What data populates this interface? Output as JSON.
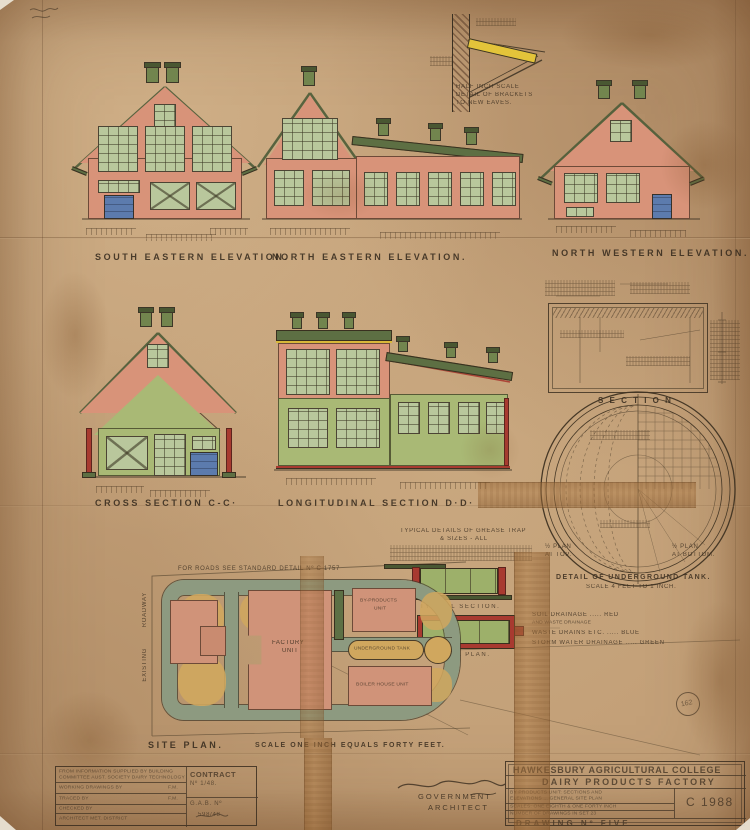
{
  "palette": {
    "paper": "#c3a078",
    "building_pink": "#d89379",
    "roof_green": "#5d6f43",
    "wall_green": "#a9b975",
    "window_green": "#b9c79c",
    "door_blue": "#5c7bad",
    "accent_red": "#a83a30",
    "beam_yellow": "#e3c43a",
    "road_grey": "#8d9a80",
    "sand": "#d0a75e",
    "ink": "#3a2d1f"
  },
  "captions": {
    "south_eastern": "SOUTH EASTERN ELEVATION.",
    "north_eastern": "NORTH EASTERN ELEVATION.",
    "north_western": "NORTH WESTERN ELEVATION.",
    "cross_section": "CROSS SECTION C-C·",
    "longitudinal_section": "LONGITUDINAL SECTION D·D·",
    "roof_section": "S E C T I O N"
  },
  "bracket_detail": {
    "line1": "HALF INCH SCALE",
    "line2": "DETAIL OF BRACKETS",
    "line3": "TO NEW EAVES."
  },
  "tank_detail": {
    "half_plan_top_1": "½ PLAN",
    "half_plan_top_2": "AT TOP.",
    "half_plan_bottom_1": "½ PLAN",
    "half_plan_bottom_2": "AT BOTTOM.",
    "caption": "DETAIL OF UNDERGROUND TANK.",
    "scale": "SCALE 4 FEET TO 1 INCH."
  },
  "grease_trap": {
    "title": "TYPICAL DETAILS OF GREASE TRAP",
    "subtitle": "& SIZES - ALL",
    "section_label": "TYPICAL SECTION.",
    "plan_label": "TYPICAL PLAN."
  },
  "site_plan": {
    "roads_note": "FOR ROADS SEE STANDARD DETAIL Nº C 1757",
    "factory_1": "FACTORY",
    "factory_2": "UNIT",
    "by_products_1": "BY-PRODUCTS",
    "by_products_2": "UNIT",
    "boiler": "BOILER HOUSE UNIT",
    "underground_tank": "UNDERGROUND TANK",
    "vertical_top": "ROADWAY",
    "vertical_bottom": "EXISTING",
    "label": "SITE PLAN.",
    "scale": "SCALE ONE INCH EQUALS FORTY FEET."
  },
  "legend": {
    "line1": "SOIL DRAINAGE ..... RED",
    "line2": "AND WASTE DRAINAGE",
    "line3": "WASTE DRAINS ETC. ..... BLUE",
    "line4": "STORM WATER DRAINAGE ..... GREEN"
  },
  "title_block_left": {
    "source_line1": "FROM INFORMATION SUPPLIED BY BUILDING",
    "source_line2": "COMMITTEE AUST. SOCIETY DAIRY TECHNOLOGY",
    "working_drawings": "WORKING DRAWINGS BY",
    "working_by": "F.M.",
    "traced": "TRACED BY",
    "traced_by": "F.M.",
    "checked": "CHECKED BY",
    "architect_row": "ARCHITECT  MET. DISTRICT",
    "contract_label": "CONTRACT",
    "contract_no": "Nº 1/48.",
    "gab_label": "G.A.B. Nº",
    "gab_no": "598/48"
  },
  "signature": {
    "line1": "GOVERNMENT",
    "line2": "ARCHITECT"
  },
  "title_block_right": {
    "college": "HAWKESBURY AGRICULTURAL COLLEGE",
    "factory": "DAIRY PRODUCTS FACTORY",
    "desc_line1": "BY PRODUCTS UNIT: SECTIONS AND",
    "desc_line2": "ELEVATIONS ... GENERAL SITE PLAN",
    "scales": "SCALES: ONE EIGHTH & ONE FORTY INCH",
    "set": "NUMBER OF DRAWINGS IN SET 23",
    "drawing_no": "DRAWING Nº FIVE",
    "code": "C 1988"
  },
  "stamp": {
    "number": "162"
  }
}
